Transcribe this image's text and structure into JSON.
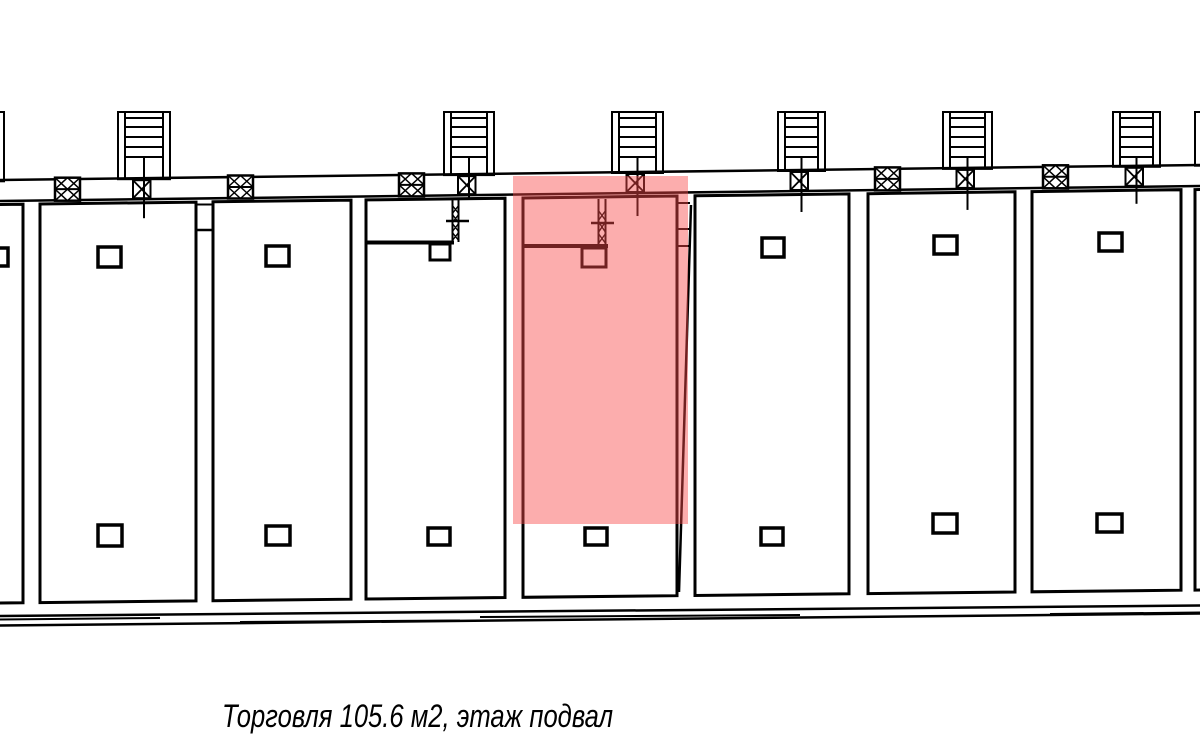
{
  "meta": {
    "background": "#ffffff",
    "drawing_type": "floor-plan"
  },
  "caption": {
    "label": "Торговля 105.6 м2, этаж подвал",
    "usage_type": "Торговля",
    "area": "105.6 м2",
    "floor": "подвал"
  },
  "highlight": {
    "x": 513,
    "y": 176,
    "width": 175,
    "height": 348,
    "color": "#f84949",
    "opacity": 0.45
  },
  "plan": {
    "width": 1200,
    "height": 745,
    "line_color": "#000000",
    "top_wall": {
      "y_left": 180,
      "y_right": 165,
      "thickness": 22
    },
    "room_bottom": {
      "y_left": 603,
      "y_right": 590
    },
    "bottom_wall": {
      "top_y_left": 616,
      "top_y_right": 605.5,
      "bot_y_left": 625.5,
      "bot_y_right": 613.5
    },
    "stair_top_y": 112,
    "tread_offsets": [
      6,
      15,
      25,
      35,
      45
    ],
    "rooms": [
      {
        "x1": -16,
        "x2": 23
      },
      {
        "x1": 40,
        "x2": 196
      },
      {
        "x1": 213,
        "x2": 351
      },
      {
        "x1": 366,
        "x2": 505
      },
      {
        "x1": 523,
        "x2": 677,
        "highlighted": true
      },
      {
        "x1": 695,
        "x2": 849
      },
      {
        "x1": 868,
        "x2": 1015
      },
      {
        "x1": 1032,
        "x2": 1181
      },
      {
        "x1": 1195,
        "x2": 1240
      }
    ],
    "stairs": [
      {
        "x": -48,
        "w": 52,
        "ext": 16
      },
      {
        "x": 118,
        "w": 52,
        "ext": 18
      },
      {
        "x": 444,
        "w": 50,
        "ext": 2
      },
      {
        "x": 612,
        "w": 51,
        "ext": 22
      },
      {
        "x": 778,
        "w": 47,
        "ext": 20
      },
      {
        "x": 943,
        "w": 49,
        "ext": 20
      },
      {
        "x": 1113,
        "w": 47,
        "ext": 16
      },
      {
        "x": 1195,
        "w": 52,
        "ext": 16
      }
    ],
    "vents": [
      {
        "x": 55
      },
      {
        "x": 228
      },
      {
        "x": 399
      },
      {
        "x": 875
      },
      {
        "x": 1043
      }
    ],
    "vent_size": {
      "w": 25,
      "h": 23
    },
    "columns": [
      [
        -14,
        248,
        22,
        18
      ],
      [
        98,
        247,
        23,
        20
      ],
      [
        266,
        246,
        23,
        20
      ],
      [
        762,
        238,
        22,
        19
      ],
      [
        934,
        236,
        23,
        18
      ],
      [
        1099,
        233,
        23,
        18
      ],
      [
        98,
        525,
        24,
        21
      ],
      [
        266,
        526,
        24,
        19
      ],
      [
        428,
        528,
        22,
        17
      ],
      [
        585,
        528,
        22,
        17
      ],
      [
        761,
        528,
        22,
        17
      ],
      [
        933,
        514,
        24,
        19
      ],
      [
        1097,
        514,
        25,
        18
      ]
    ],
    "detail_rects": [
      [
        430,
        244,
        20,
        16,
        3
      ],
      [
        582,
        248,
        24,
        19,
        3
      ]
    ],
    "detail_lines": [
      [
        196,
        204.5,
        214,
        204.5,
        2
      ],
      [
        196,
        230,
        214,
        230,
        2.5
      ],
      [
        366,
        242.5,
        454,
        242.5,
        4
      ],
      [
        452.5,
        199,
        452.5,
        242,
        2
      ],
      [
        458.5,
        199,
        458.5,
        242,
        2
      ],
      [
        452,
        205,
        459,
        214,
        1.4
      ],
      [
        459,
        205,
        452,
        214,
        1.4
      ],
      [
        452,
        214,
        459,
        223,
        1.4
      ],
      [
        459,
        214,
        452,
        223,
        1.4
      ],
      [
        452,
        223,
        459,
        232,
        1.4
      ],
      [
        459,
        223,
        452,
        232,
        1.4
      ],
      [
        452,
        232,
        459,
        241,
        1.4
      ],
      [
        459,
        232,
        452,
        241,
        1.4
      ],
      [
        446,
        221,
        469,
        221,
        2.5
      ],
      [
        523,
        246,
        608,
        246,
        4
      ],
      [
        598.5,
        199,
        598.5,
        245,
        2
      ],
      [
        605.5,
        199,
        605.5,
        245,
        2
      ],
      [
        598,
        210,
        606,
        221,
        1.4
      ],
      [
        606,
        210,
        598,
        221,
        1.4
      ],
      [
        598,
        221,
        606,
        233,
        1.4
      ],
      [
        606,
        221,
        598,
        233,
        1.4
      ],
      [
        598,
        233,
        606,
        244,
        1.4
      ],
      [
        606,
        233,
        598,
        244,
        1.4
      ],
      [
        591,
        223,
        614,
        223,
        2.5
      ],
      [
        691,
        205,
        679,
        592,
        2.5
      ],
      [
        677,
        203,
        690,
        203,
        2
      ],
      [
        677,
        229,
        690,
        229,
        2
      ],
      [
        677,
        246,
        690,
        246,
        2
      ],
      [
        0,
        619.5,
        160,
        618,
        2
      ],
      [
        480,
        617,
        800,
        615,
        2
      ],
      [
        1050,
        614,
        1200,
        612.5,
        2
      ],
      [
        240,
        622,
        460,
        620.5,
        2
      ]
    ]
  }
}
